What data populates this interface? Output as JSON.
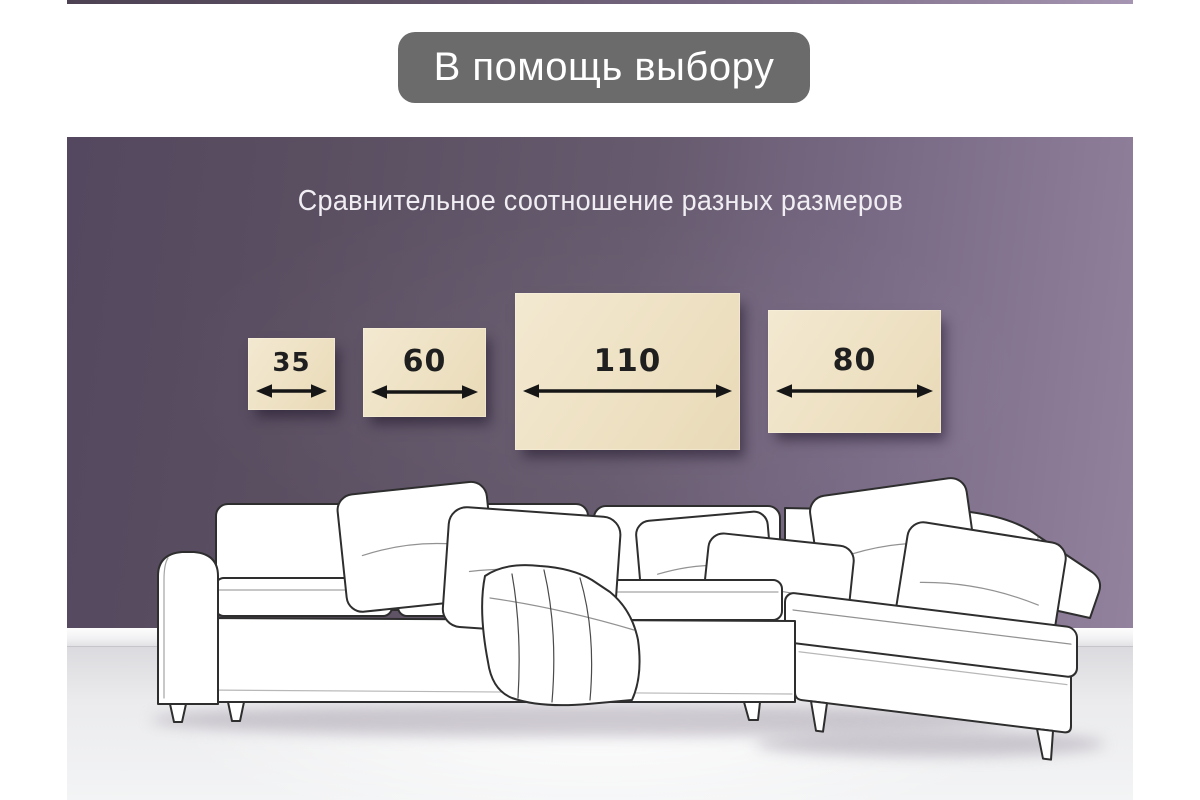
{
  "header": {
    "badge": {
      "label": "В помощь выбору",
      "bg_color": "#6b6b6b",
      "text_color": "#ffffff"
    }
  },
  "scene": {
    "title": "Сравнительное соотношение разных размеров",
    "title_color": "#f1eef3",
    "wall_colors": [
      "#544860",
      "#665a6e",
      "#93829e"
    ],
    "floor_color": "#ededef",
    "size_comparison": {
      "fill_color": "#eee1c3",
      "label_color": "#1f1f1f",
      "arrow_color": "#161616",
      "items": [
        {
          "label": "35",
          "value": 35,
          "w": 87,
          "h": 72,
          "x": 181,
          "y": 201,
          "font": 26
        },
        {
          "label": "60",
          "value": 60,
          "w": 123,
          "h": 89,
          "x": 296,
          "y": 191,
          "font": 30
        },
        {
          "label": "110",
          "value": 110,
          "w": 225,
          "h": 157,
          "x": 448,
          "y": 156,
          "font": 31
        },
        {
          "label": "80",
          "value": 80,
          "w": 173,
          "h": 123,
          "x": 701,
          "y": 173,
          "font": 30
        }
      ]
    },
    "illustration": "white-corner-sofa-line-drawing"
  }
}
